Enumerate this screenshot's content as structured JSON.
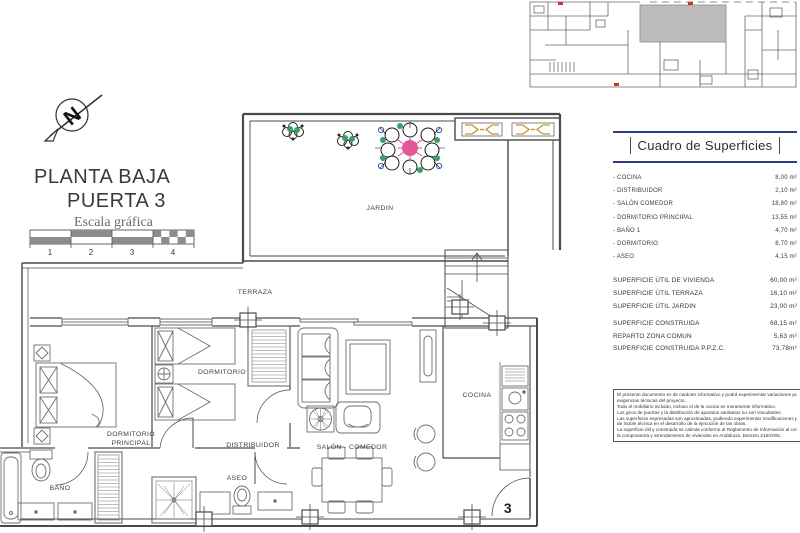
{
  "title_block": {
    "line1": "PLANTA BAJA",
    "line2": "PUERTA 3",
    "scale_caption": "Escala gráfica"
  },
  "compass": {
    "letter": "N"
  },
  "scale_bar": {
    "ticks": [
      "1",
      "2",
      "3",
      "4"
    ]
  },
  "floor_plan": {
    "rooms": {
      "jardin": "JARDIN",
      "terraza": "TERRAZA",
      "dormitorio": "DORMITORIO",
      "dormitorio_principal_1": "DORMITORIO",
      "dormitorio_principal_2": "PRINCIPAL",
      "bano": "BAÑO",
      "distribuidor": "DISTRIBUIDOR",
      "aseo": "ASEO",
      "salon": "SALÓN - COMEDOR",
      "cocina": "COCINA"
    },
    "door_number": "3"
  },
  "surfaces_panel": {
    "header": "Cuadro de Superficies",
    "rows": [
      {
        "label": "- COCINA",
        "value": "8,00 m²"
      },
      {
        "label": "- DISTRIBUIDOR",
        "value": "2,10 m²"
      },
      {
        "label": "- SALÓN COMEDOR",
        "value": "18,80 m²"
      },
      {
        "label": "- DORMITORIO PRINCIPAL",
        "value": "13,55 m²"
      },
      {
        "label": "- BAÑO 1",
        "value": "4,70 m²"
      },
      {
        "label": "- DORMITORIO",
        "value": "8,70 m²"
      },
      {
        "label": "- ASEO",
        "value": "4,15 m²"
      }
    ],
    "useful": [
      {
        "label": "SUPERFICIE ÚTIL DE VIVIENDA",
        "value": "60,00 m²"
      },
      {
        "label": "SUPERFICIE ÚTIL TERRAZA",
        "value": "16,10 m²"
      },
      {
        "label": "SUPERFICIE ÚTIL JARDIN",
        "value": "23,00 m²"
      }
    ],
    "built": [
      {
        "label": "SUPERFICIE CONSTRUIDA",
        "value": "68,15 m²"
      },
      {
        "label": "REPARTO ZONA COMUN",
        "value": "5,63 m²"
      },
      {
        "label": "SUPERFICIE CONSTRUIDA P.P.Z.C.",
        "value": "73,78m²"
      }
    ]
  },
  "disclaimer": {
    "lines": [
      "El presente documento es de carácter informativo y podrá experimentar variaciones por",
      "exigencias técnicas del proyecto.",
      "Todo el mobiliario incluido, incluso el de la cocina es meramente informativo.",
      "Los giros de puertas y la distribución de aparatos sanitarios no son vinculantes.",
      "Las superficies expresadas son aproximadas, pudiendo experimentar modificaciones por razones",
      "de índole técnica en el desarrollo de la ejecución de las obras.",
      "La superficie útil y construida se calcula conforme al Reglamento de Información al consumidor en",
      "la compraventa y arrendamiento de viviendas en Andalucía. Decreto 218/2005."
    ]
  },
  "colors": {
    "accent_navy": "#2d3a8c",
    "wall_gray": "#4a4a4a",
    "louver_orange": "#c8922f",
    "plant_green": "#3f9e63",
    "flower_pink": "#e5559a"
  }
}
